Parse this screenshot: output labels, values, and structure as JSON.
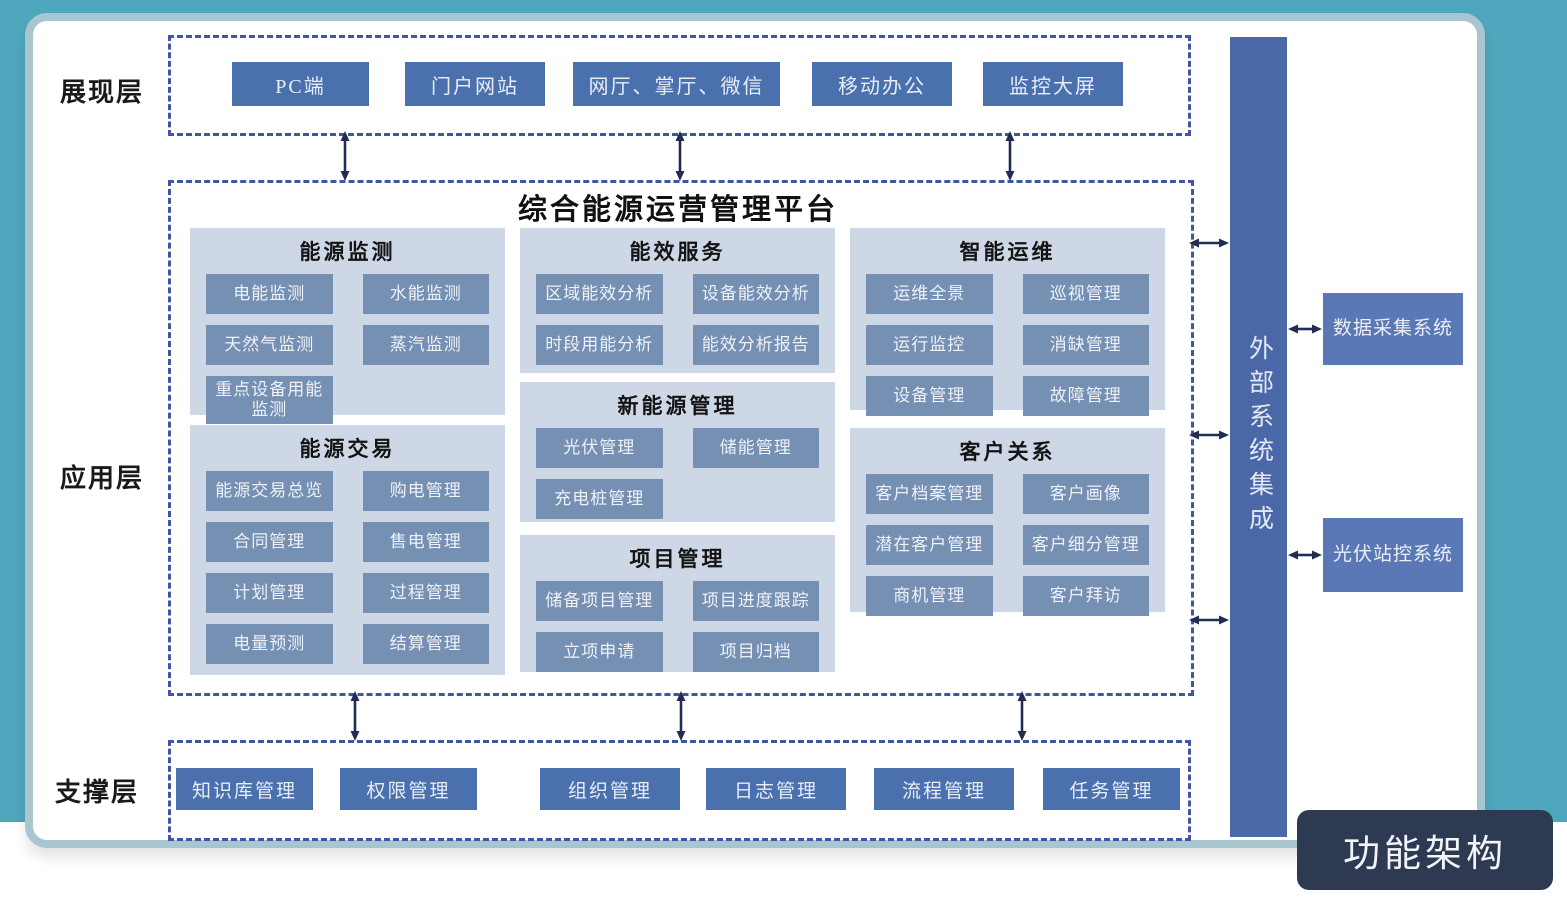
{
  "page": {
    "badge": "功能架构"
  },
  "layers": {
    "presentation": {
      "label": "展现层",
      "items": [
        "PC端",
        "门户网站",
        "网厅、掌厅、微信",
        "移动办公",
        "监控大屏"
      ]
    },
    "application": {
      "label": "应用层",
      "platform_title": "综合能源运营管理平台",
      "groups": [
        {
          "title": "能源监测",
          "items": [
            "电能监测",
            "水能监测",
            "天然气监测",
            "蒸汽监测",
            "重点设备用能监测"
          ]
        },
        {
          "title": "能效服务",
          "items": [
            "区域能效分析",
            "设备能效分析",
            "时段用能分析",
            "能效分析报告"
          ]
        },
        {
          "title": "智能运维",
          "items": [
            "运维全景",
            "巡视管理",
            "运行监控",
            "消缺管理",
            "设备管理",
            "故障管理"
          ]
        },
        {
          "title": "能源交易",
          "items": [
            "能源交易总览",
            "购电管理",
            "合同管理",
            "售电管理",
            "计划管理",
            "过程管理",
            "电量预测",
            "结算管理"
          ]
        },
        {
          "title": "新能源管理",
          "items": [
            "光伏管理",
            "储能管理",
            "充电桩管理"
          ]
        },
        {
          "title": "项目管理",
          "items": [
            "储备项目管理",
            "项目进度跟踪",
            "立项申请",
            "项目归档"
          ]
        },
        {
          "title": "客户关系",
          "items": [
            "客户档案管理",
            "客户画像",
            "潜在客户管理",
            "客户细分管理",
            "商机管理",
            "客户拜访"
          ]
        }
      ]
    },
    "support": {
      "label": "支撑层",
      "items": [
        "知识库管理",
        "权限管理",
        "组织管理",
        "日志管理",
        "流程管理",
        "任务管理"
      ]
    }
  },
  "external": {
    "bar_label": "外部系统集成",
    "systems": [
      "数据采集系统",
      "光伏站控系统"
    ]
  },
  "colors": {
    "teal_frame": "#4ea7bc",
    "panel_border": "#a9c6d0",
    "dashed_border": "#4156a2",
    "primary_button": "#4a70ad",
    "group_panel": "#cdd7e5",
    "group_item": "#7590b3",
    "external_bar": "#4a68a8",
    "system_box": "#5b78b6",
    "badge_bg": "#2e3a52",
    "arrow": "#232c52"
  }
}
